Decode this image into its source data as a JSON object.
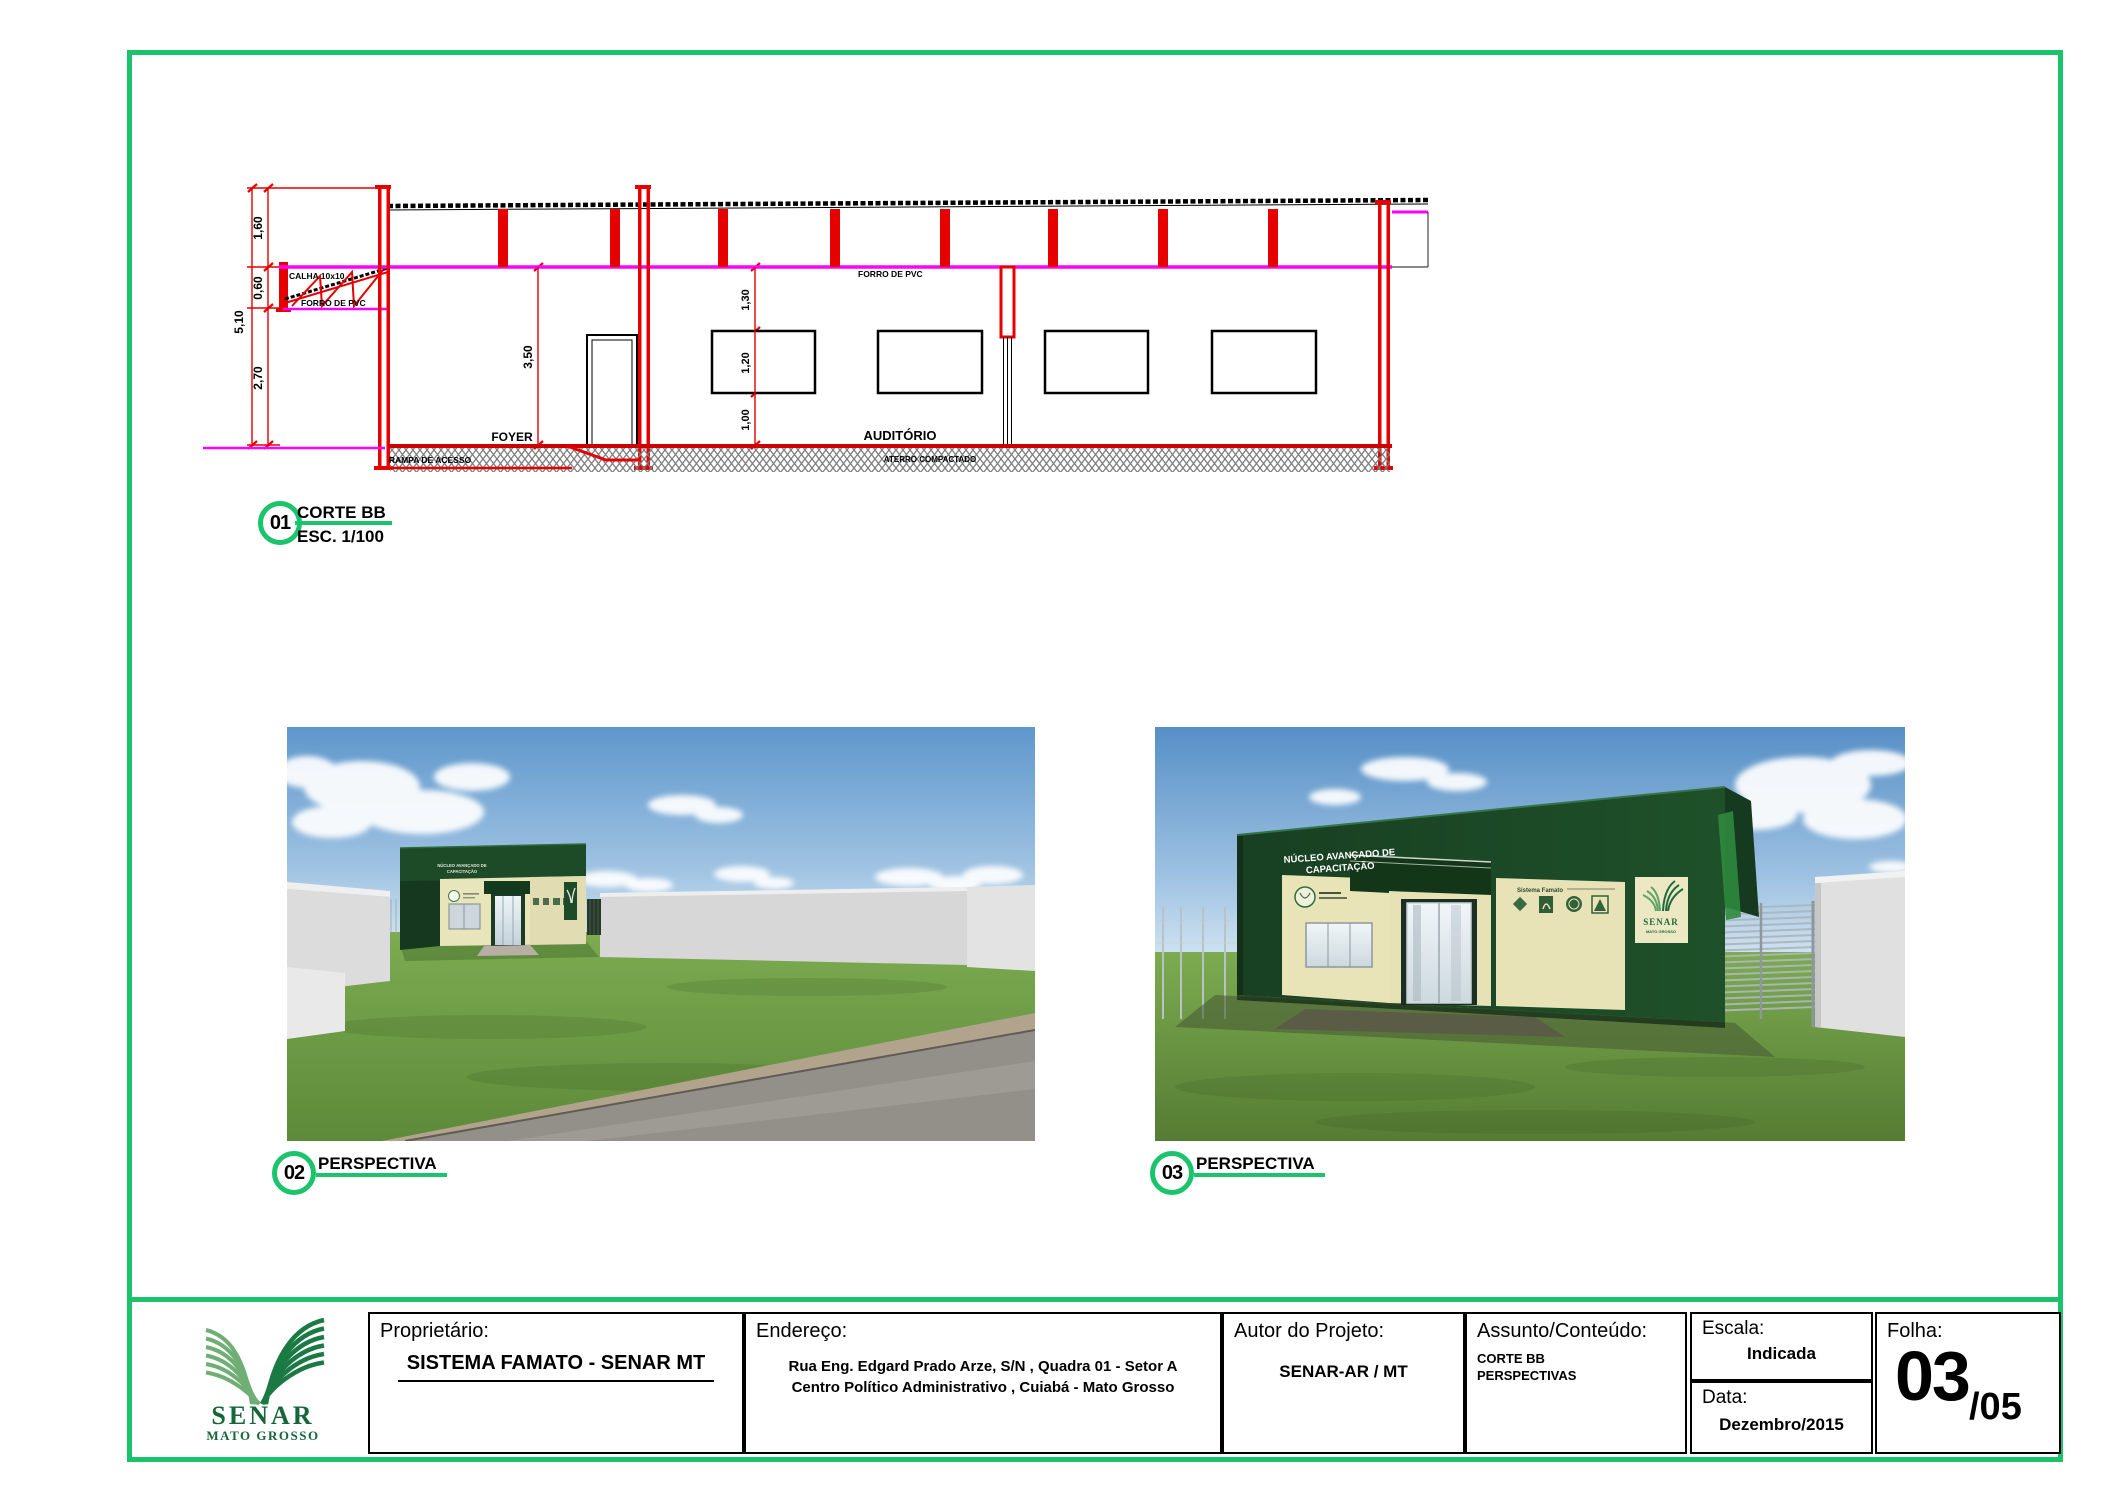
{
  "colors": {
    "accent_green": "#1bc46c",
    "drawing_red": "#e60000",
    "ceiling_magenta": "#ff00ff",
    "logo_dark_green": "#17663a",
    "logo_light_green": "#6fae74"
  },
  "drawing": {
    "callout": {
      "number": "01",
      "title": "CORTE BB",
      "scale": "ESC. 1/100"
    },
    "labels": {
      "calha": "CALHA 10x10",
      "forro_pvc_left": "FORRO DE PVC",
      "forro_pvc": "FORRO DE PVC",
      "foyer": "FOYER",
      "auditorio": "AUDITÓRIO",
      "aterro": "ATERRO COMPACTADO",
      "rampa": "RAMPA DE ACESSO"
    },
    "dims": {
      "total": "5,10",
      "d160": "1,60",
      "d060": "0,60",
      "d270": "2,70",
      "d350": "3,50",
      "d130": "1,30",
      "d120": "1,20",
      "d100": "1,00"
    }
  },
  "perspective02": {
    "callout": {
      "number": "02",
      "title": "PERSPECTIVA"
    },
    "sign_line1": "NÚCLEO AVANÇADO DE",
    "sign_line2": "CAPACITAÇÃO"
  },
  "perspective03": {
    "callout": {
      "number": "03",
      "title": "PERSPECTIVA"
    },
    "sign_line1": "NÚCLEO AVANÇADO DE",
    "sign_line2": "CAPACITAÇÃO",
    "logos_caption": "Sistema Famato",
    "senar_panel": {
      "title": "SENAR",
      "subtitle": "MATO GROSSO"
    }
  },
  "title_block": {
    "logo": {
      "name": "SENAR",
      "region": "MATO GROSSO"
    },
    "fields": {
      "proprietario": {
        "label": "Proprietário:",
        "value": "SISTEMA FAMATO - SENAR MT"
      },
      "endereco": {
        "label": "Endereço:",
        "line1": "Rua Eng. Edgard Prado Arze, S/N , Quadra 01 - Setor A",
        "line2": "Centro Político Administrativo , Cuiabá - Mato Grosso"
      },
      "autor": {
        "label": "Autor do Projeto:",
        "value": "SENAR-AR / MT"
      },
      "assunto": {
        "label": "Assunto/Conteúdo:",
        "line1": "CORTE BB",
        "line2": "PERSPECTIVAS"
      },
      "escala": {
        "label": "Escala:",
        "value": "Indicada"
      },
      "data": {
        "label": "Data:",
        "value": "Dezembro/2015"
      },
      "folha": {
        "label": "Folha:",
        "number": "03",
        "total": "/05"
      }
    }
  }
}
